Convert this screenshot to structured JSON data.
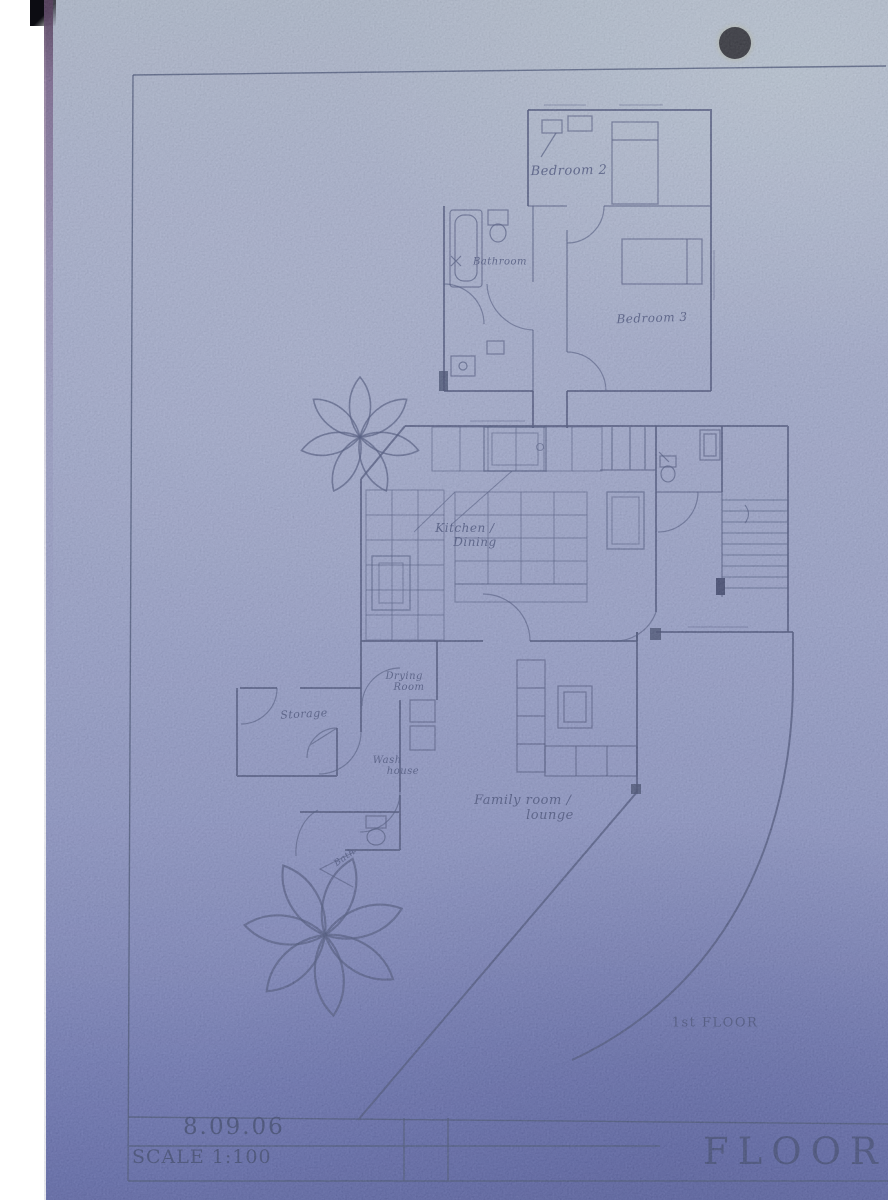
{
  "rooms": {
    "bedroom2": "Bedroom 2",
    "bathroom": "Bathroom",
    "bedroom3": "Bedroom 3",
    "kitchen_dining": {
      "line1": "Kitchen /",
      "line2": "Dining"
    },
    "drying_room": {
      "line1": "Drying",
      "line2": "Room"
    },
    "storage": "Storage",
    "wash_house": {
      "line1": "Wash",
      "line2": "house"
    },
    "bath": "Bath",
    "family_lounge": {
      "line1": "Family room /",
      "line2": "lounge"
    },
    "floor_label": "1st FLOOR"
  },
  "title_block": {
    "date": "8.09.06",
    "scale": "SCALE 1:100",
    "title_partial": "FLOOR PL"
  },
  "colors": {
    "paper_top": "#aab5c4",
    "paper_middle": "#8d96c0",
    "paper_bottom": "#434d96",
    "pencil": "#2c3763",
    "hole_punch": "#0b0b0d",
    "scan_background": "#ffffff"
  }
}
